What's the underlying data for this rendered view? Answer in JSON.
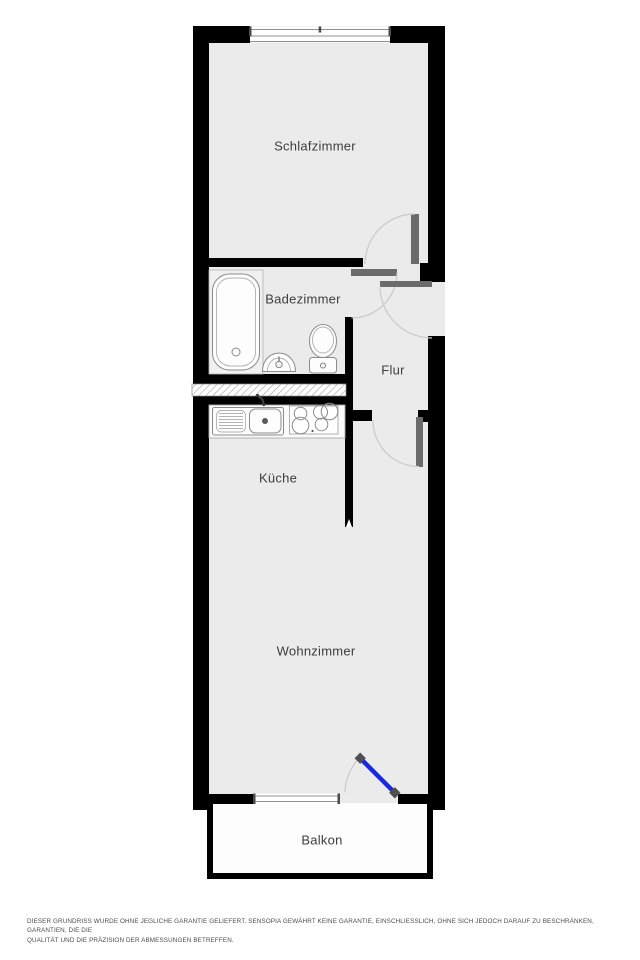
{
  "floorplan": {
    "rooms": [
      {
        "id": "schlafzimmer",
        "label": "Schlafzimmer"
      },
      {
        "id": "badezimmer",
        "label": "Badezimmer"
      },
      {
        "id": "flur",
        "label": "Flur"
      },
      {
        "id": "kueche",
        "label": "Küche"
      },
      {
        "id": "wohnzimmer",
        "label": "Wohnzimmer"
      },
      {
        "id": "balkon",
        "label": "Balkon"
      }
    ],
    "fixtures": [
      "bathtub",
      "washbasin",
      "toilet",
      "kitchen-sink",
      "stove",
      "kitchen-counter"
    ],
    "doors": [
      "schlafzimmer-door",
      "badezimmer-door",
      "entry-door",
      "flur-door",
      "balcony-door"
    ],
    "windows": [
      "schlafzimmer-window",
      "wohnzimmer-window"
    ],
    "colors": {
      "wall": "#000000",
      "floor": "#ebebeb",
      "door_leaf": "#6b6b6b",
      "swing_arc": "#c9c9c9",
      "balcony_door": "#1727e3",
      "label_text": "#3d3d3d",
      "fixture_line": "#8b8b8b"
    }
  },
  "disclaimer": {
    "line1": "DIESER GRUNDRISS WURDE OHNE JEGLICHE GARANTIE GELIEFERT. SENSOPIA GEWÄHRT KEINE GARANTIE, EINSCHLIESSLICH, OHNE SICH JEDOCH DARAUF ZU BESCHRÄNKEN, GARANTIEN, DIE DIE",
    "line2": "QUALITÄT UND DIE PRÄZISION DER ABMESSUNGEN BETREFFEN."
  }
}
